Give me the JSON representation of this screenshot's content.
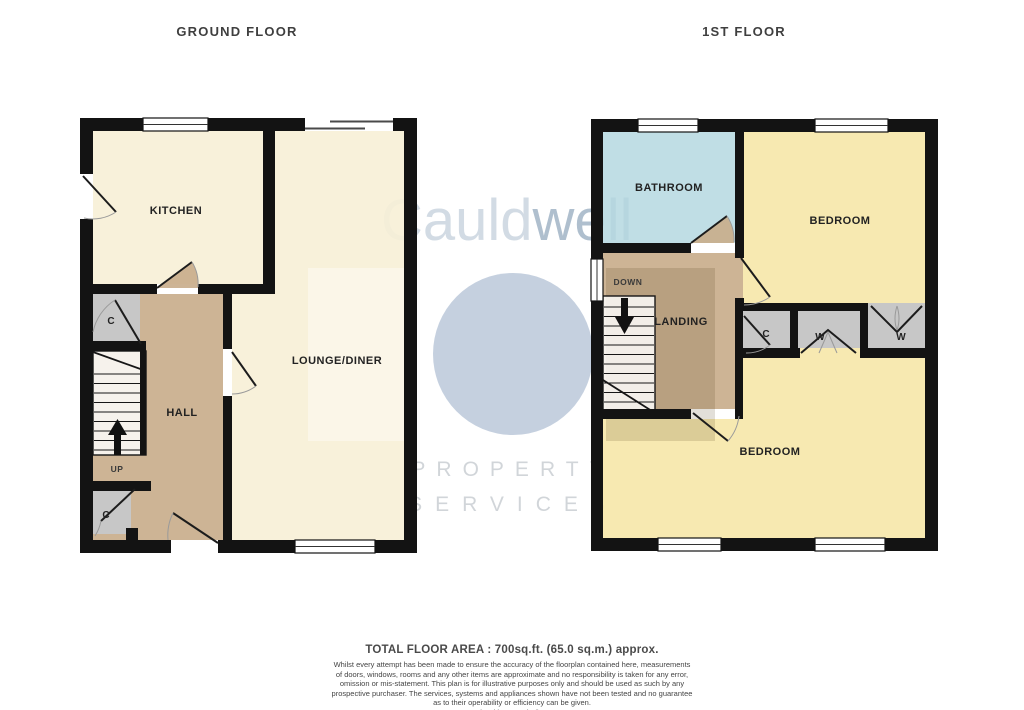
{
  "titles": {
    "ground": "GROUND FLOOR",
    "first": "1ST FLOOR"
  },
  "watermark": {
    "brand_light": "Cauld",
    "brand_dark": "well",
    "line1": "PROPERTY",
    "line2": "SERVICES"
  },
  "ground_floor": {
    "kitchen": "KITCHEN",
    "lounge": "LOUNGE/DINER",
    "hall": "HALL",
    "closet_top": "C",
    "closet_bottom": "C",
    "up": "UP"
  },
  "first_floor": {
    "bathroom": "BATHROOM",
    "bedroom_front": "BEDROOM",
    "bedroom_back": "BEDROOM",
    "landing": "LANDING",
    "down": "DOWN",
    "closet": "C",
    "wardrobe_left": "W",
    "wardrobe_right": "W"
  },
  "footer": {
    "total_area": "TOTAL FLOOR AREA : 700sq.ft. (65.0 sq.m.) approx.",
    "disclaimer_line1": "Whilst every attempt has been made to ensure the accuracy of the floorplan contained here, measurements",
    "disclaimer_line2": "of doors, windows, rooms and any other items are approximate and no responsibility is taken for any error,",
    "disclaimer_line3": "omission or mis-statement. This plan is for illustrative purposes only and should be used as such by any",
    "disclaimer_line4": "prospective purchaser. The services, systems and appliances shown have not been tested and no guarantee",
    "disclaimer_line5": "as to their operability or efficiency can be given.",
    "credit": "Made with Metropix ©2025"
  },
  "colors": {
    "wall": "#131313",
    "cream": "#F7F0D6",
    "tan": "#C9AE8C",
    "closet_gray": "#C7C7C7",
    "bathroom_blue": "#B7DAE1",
    "bedroom_yellow": "#F6E7A9",
    "watermark_blue": "#8298AF"
  }
}
